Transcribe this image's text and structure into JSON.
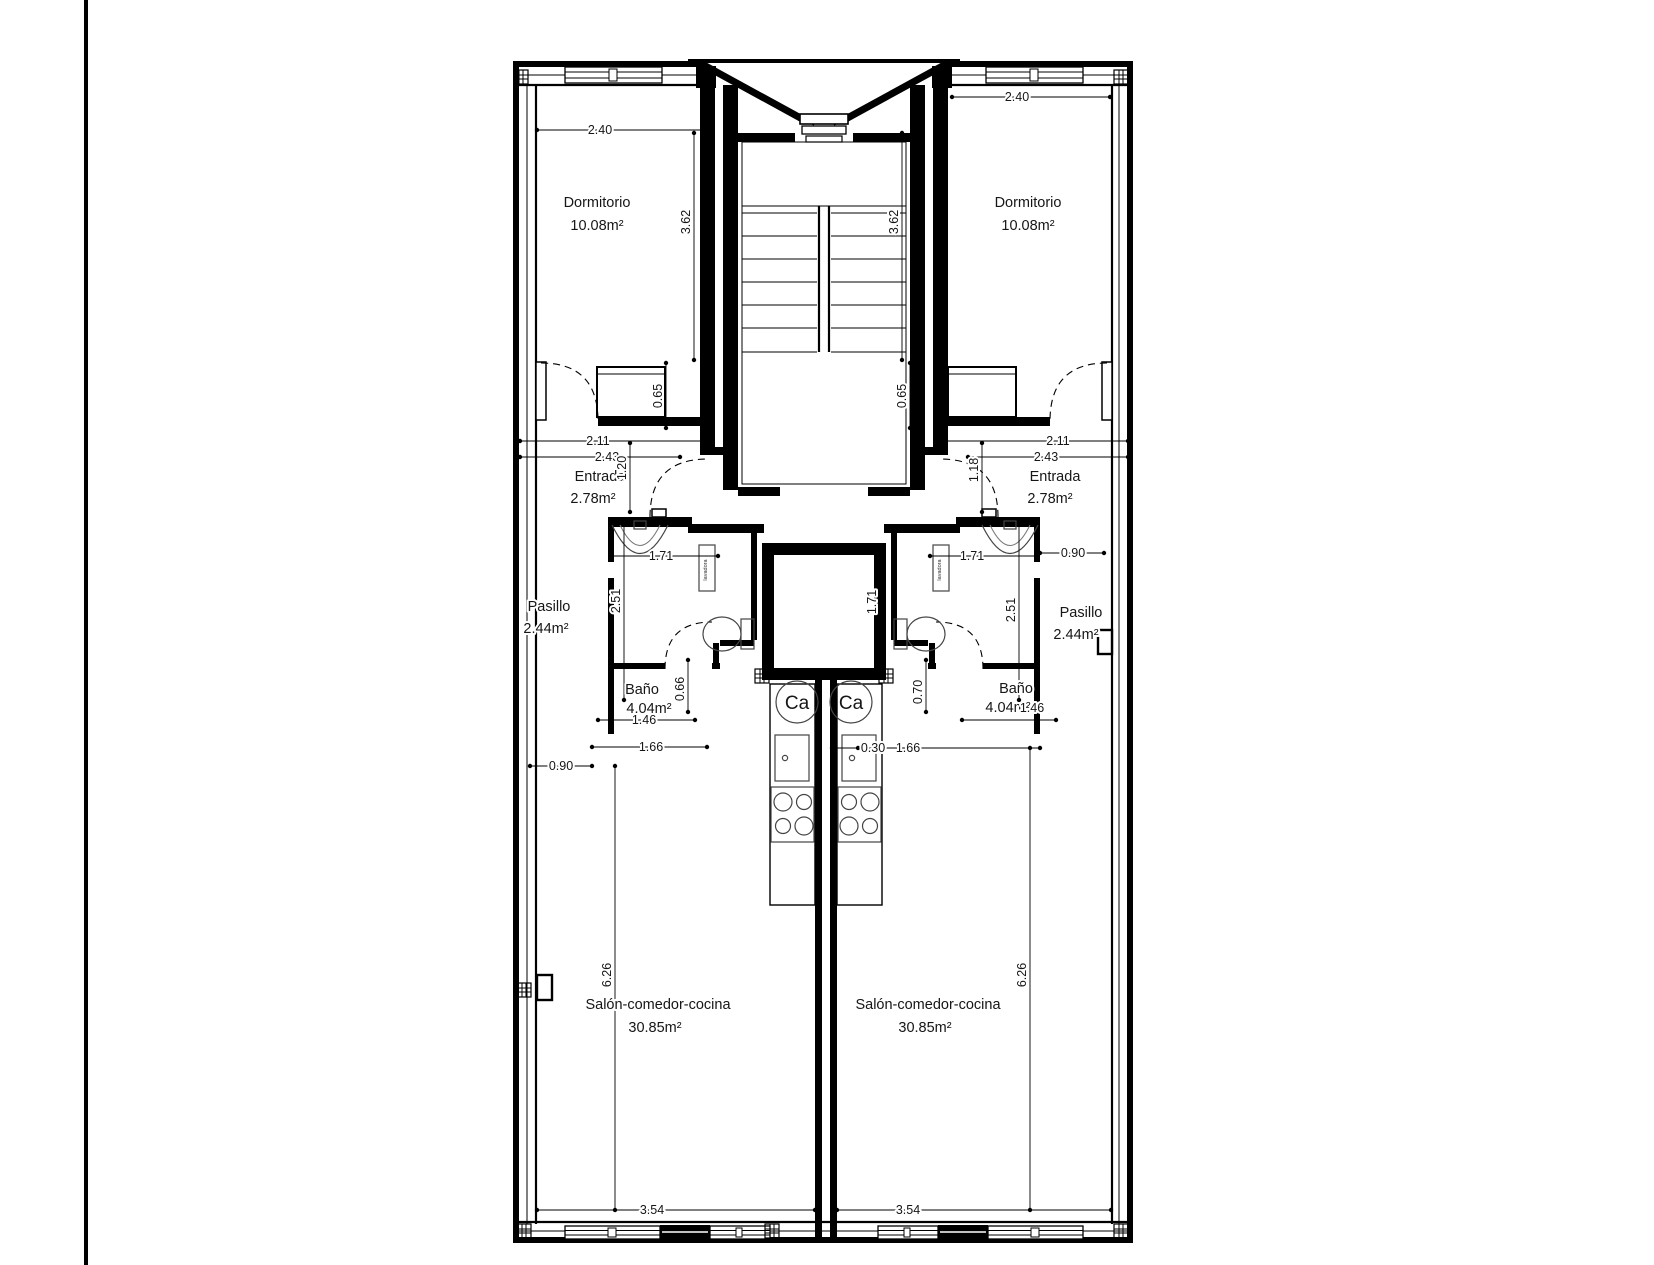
{
  "plan": {
    "boiler_label": "Ca",
    "washer_label": "lavadora",
    "left": {
      "dormitorio_label": "Dormitorio",
      "dormitorio_area": "10.08m²",
      "entrada_label": "Entrada",
      "entrada_area": "2.78m²",
      "pasillo_label": "Pasillo",
      "pasillo_area": "2.44m²",
      "bano_label": "Baño",
      "bano_area": "4.04m²",
      "salon_label": "Salón-comedor-cocina",
      "salon_area": "30.85m²",
      "dim_bed_width": "2.40",
      "dim_bed_depth": "3.62",
      "dim_closet_depth": "0.65",
      "dim_entry_w1": "2.11",
      "dim_entry_w2": "2.43",
      "dim_entry_depth": "1.20",
      "dim_bath_width": "1.71",
      "dim_bath_depth": "2.51",
      "dim_bath_door": "0.66",
      "dim_bath_inner": "1.46",
      "dim_kitchen_width": "1.66",
      "dim_pass_width": "0.90",
      "dim_salon_depth": "6.26",
      "dim_salon_width": "3.54"
    },
    "right": {
      "dormitorio_label": "Dormitorio",
      "dormitorio_area": "10.08m²",
      "entrada_label": "Entrada",
      "entrada_area": "2.78m²",
      "pasillo_label": "Pasillo",
      "pasillo_area": "2.44m²",
      "bano_label": "Baño",
      "bano_area": "4.04m²",
      "salon_label": "Salón-comedor-cocina",
      "salon_area": "30.85m²",
      "dim_bed_width": "2.40",
      "dim_bed_depth": "3.62",
      "dim_closet_depth": "0.65",
      "dim_entry_w1": "2.11",
      "dim_entry_w2": "2.43",
      "dim_entry_depth": "1.18",
      "dim_bath_width": "1.71",
      "dim_bath_width_v": "1.71",
      "dim_bath_depth": "2.51",
      "dim_bath_door": "0.70",
      "dim_bath_inner": "1.46",
      "dim_counter_gap": "0.30",
      "dim_kitchen_width": "1.66",
      "dim_pass_width": "0.90",
      "dim_salon_depth": "6.26",
      "dim_salon_width": "3.54"
    }
  }
}
